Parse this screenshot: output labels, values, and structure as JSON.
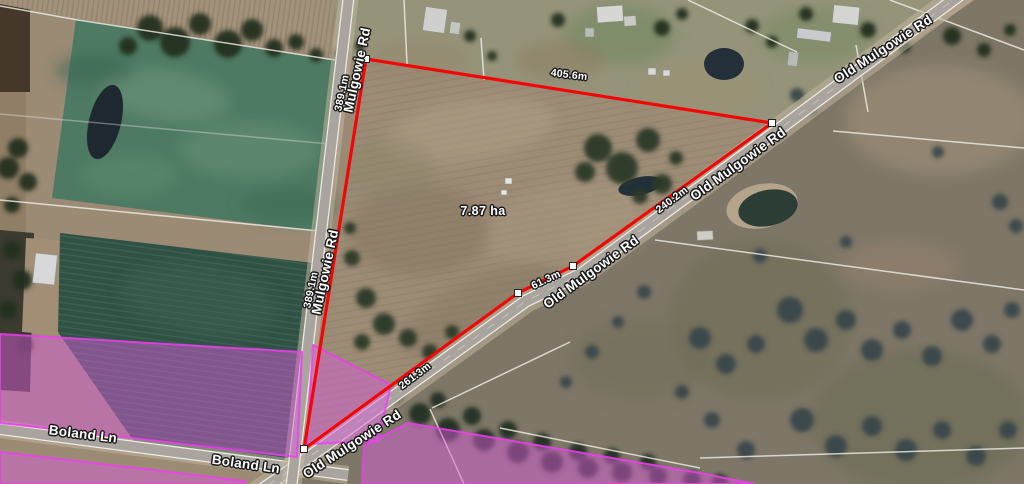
{
  "map": {
    "parcel": {
      "area": "7.87 ha",
      "edge_lengths": {
        "north": "405.6m",
        "west": "389.1m",
        "northeast": "240.2m",
        "road_short": "61.3m",
        "road_long": "261.3m"
      }
    },
    "roads": {
      "mulgowie": "Mulgowie Rd",
      "old_mulgowie": "Old Mulgowie Rd",
      "boland": "Boland Ln"
    },
    "colors": {
      "boundary_red": "#f40606",
      "zone_pink_fill": "#d95cdb",
      "zone_pink_border": "#ef3df0",
      "vertex_marker": "#ffffff"
    }
  }
}
